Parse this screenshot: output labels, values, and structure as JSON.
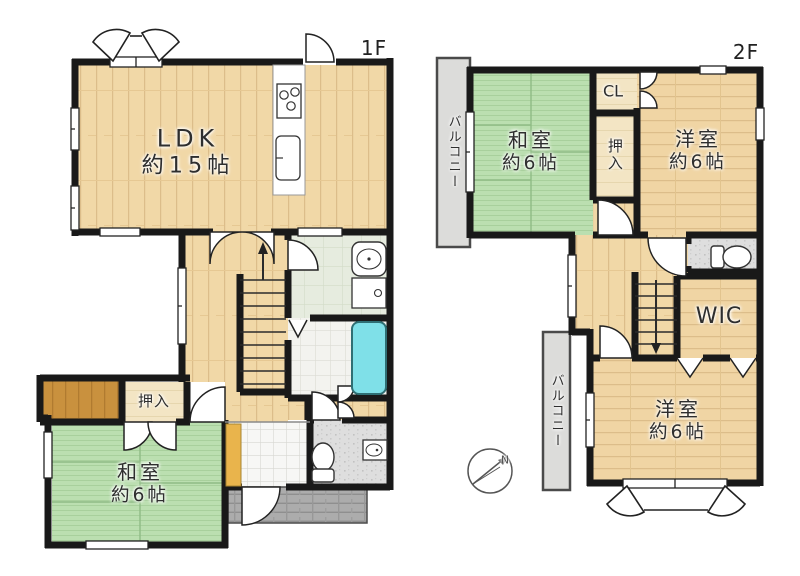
{
  "floors": {
    "f1": {
      "label": "1F",
      "rooms": {
        "ldk": {
          "name": "LDK",
          "size": "約15帖"
        },
        "washitsu": {
          "name": "和室",
          "size": "約6帖"
        },
        "oshiire": {
          "name": "押入"
        }
      }
    },
    "f2": {
      "label": "2F",
      "rooms": {
        "washitsu": {
          "name": "和室",
          "size": "約6帖"
        },
        "yoshitsu_north": {
          "name": "洋室",
          "size": "約6帖"
        },
        "yoshitsu_south": {
          "name": "洋室",
          "size": "約6帖"
        },
        "cl": {
          "name": "CL"
        },
        "oshiire": {
          "name": "押入"
        },
        "wic": {
          "name": "WIC"
        },
        "balcony_north": {
          "name": "バルコニー"
        },
        "balcony_south": {
          "name": "バルコニー"
        }
      }
    }
  },
  "compass": {
    "north_label": "N"
  },
  "colors": {
    "wall": "#191919",
    "wood_floor": "#f0d7a6",
    "tatami": "#b9dcae",
    "bathtub": "#7fe0e8",
    "balcony": "#dcdcda",
    "porch": "#acacac",
    "closet_wood": "#f3e5c4",
    "storage_wood": "#c9913e",
    "shoe_cabinet": "#e9b44c"
  }
}
